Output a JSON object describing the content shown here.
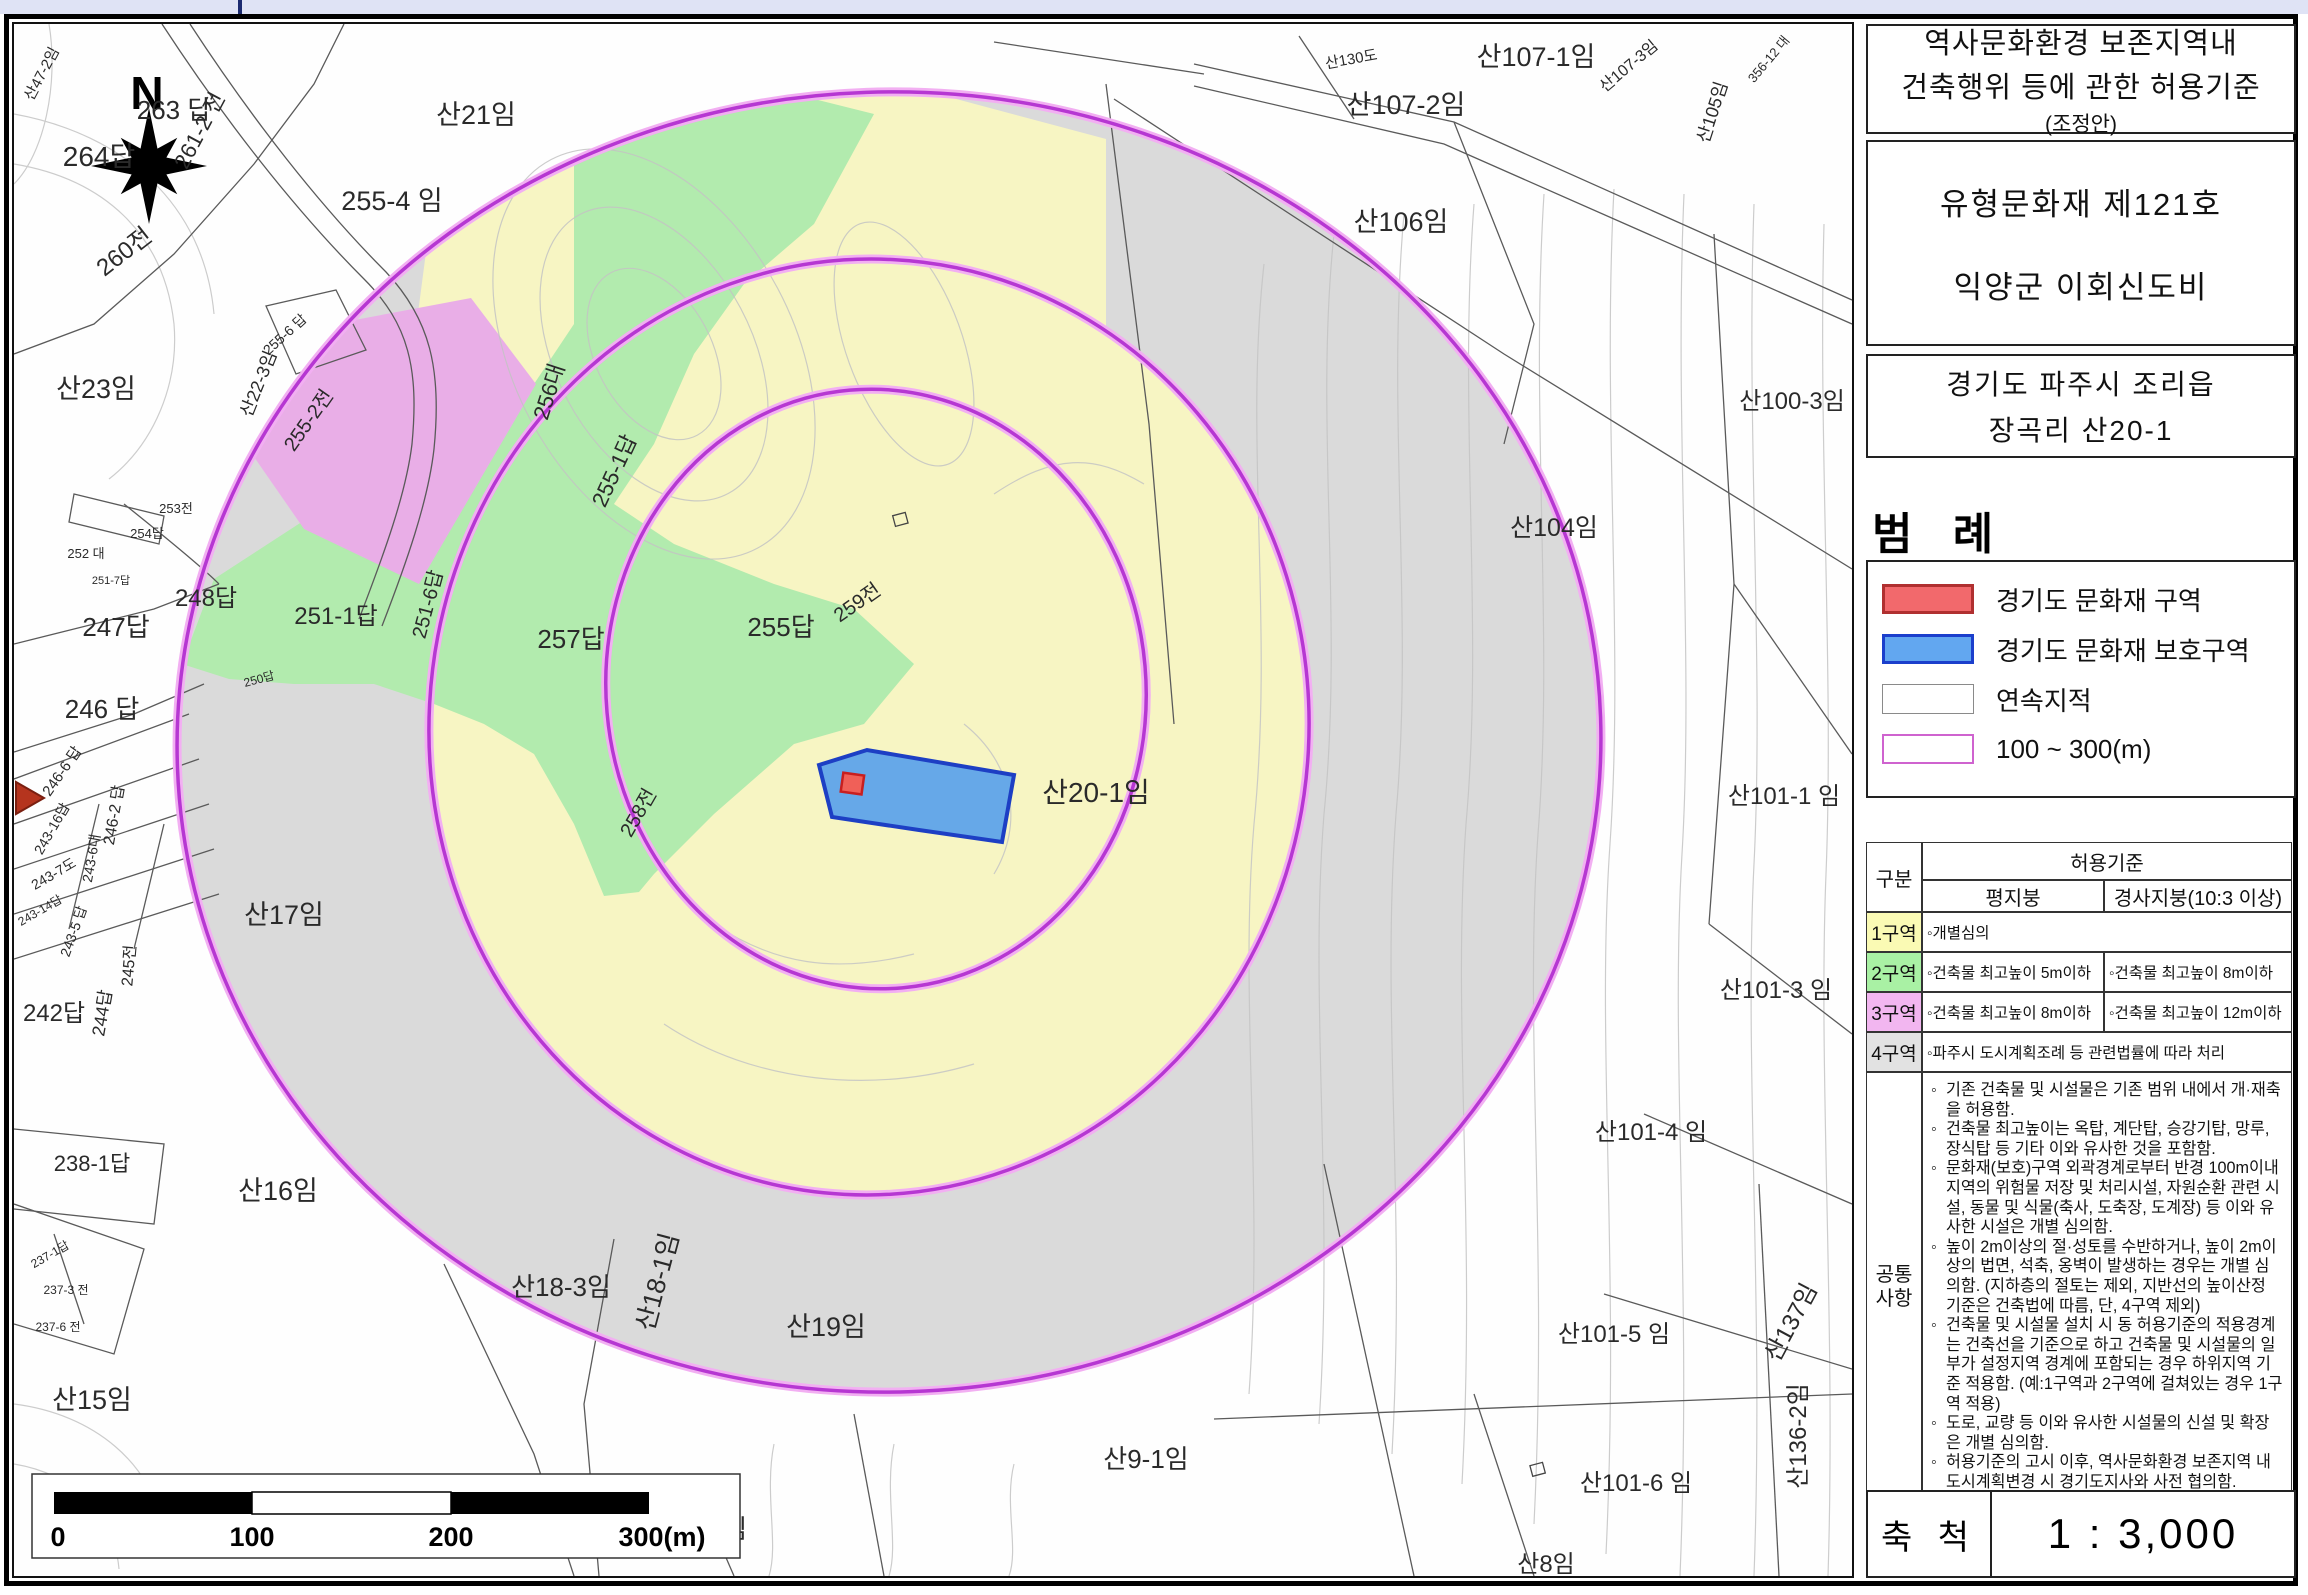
{
  "window": {
    "top_strip_color": "#dfe3f5",
    "frame_color": "#000000"
  },
  "side_panel": {
    "title_box": {
      "line1": "역사문화환경 보존지역내",
      "line2": "건축행위 등에 관한 허용기준",
      "line3": "(조정안)"
    },
    "heritage_box": {
      "line1": "유형문화재 제121호",
      "line2": "익양군 이회신도비"
    },
    "address_box": {
      "line1": "경기도 파주시 조리읍",
      "line2": "장곡리 산20-1"
    },
    "legend": {
      "title": "범 례",
      "items": [
        {
          "label": "경기도 문화재 구역",
          "fill": "#f2696c",
          "border": "#b03030"
        },
        {
          "label": "경기도 문화재 보호구역",
          "fill": "#62a7f0",
          "border": "#1b3fcc"
        },
        {
          "label": "연속지적",
          "fill": "#ffffff",
          "border": "#8a8a8a"
        },
        {
          "label": "100 ~ 300(m)",
          "fill": "#ffffff",
          "border": "#cf63cf"
        }
      ]
    },
    "table": {
      "col_header": "구분",
      "span_header": "허용기준",
      "sub_headers": [
        "평지붕",
        "경사지붕(10:3 이상)"
      ],
      "rows": [
        {
          "zone": "1구역",
          "color": "#fafab4",
          "flat": "◦개별심의",
          "slope": "",
          "span": true
        },
        {
          "zone": "2구역",
          "color": "#a9f1a4",
          "flat": "◦건축물 최고높이 5m이하",
          "slope": "◦건축물 최고높이 8m이하",
          "span": false
        },
        {
          "zone": "3구역",
          "color": "#f2b6f0",
          "flat": "◦건축물 최고높이 8m이하",
          "slope": "◦건축물 최고높이 12m이하",
          "span": false
        },
        {
          "zone": "4구역",
          "color": "#e2e2e2",
          "flat": "◦파주시 도시계획조례 등 관련법률에 따라 처리",
          "slope": "",
          "span": true
        }
      ],
      "common": {
        "zone_line1": "공통",
        "zone_line2": "사항",
        "bullets": [
          "기존 건축물 및 시설물은 기존 범위 내에서 개·재축을 허용함.",
          "건축물 최고높이는 옥탑, 계단탑, 승강기탑, 망루, 장식탑 등 기타 이와 유사한 것을 포함함.",
          "문화재(보호)구역 외곽경계로부터 반경 100m이내 지역의 위험물 저장 및 처리시설, 자원순환 관련 시설, 동물 및 식물(축사, 도축장, 도계장) 등 이와 유사한 시설은 개별 심의함.",
          "높이 2m이상의 절·성토를 수반하거나, 높이 2m이상의 법면, 석축, 옹벽이 발생하는 경우는 개별 심의함. (지하층의 절토는 제외, 지반선의 높이산정 기준은 건축법에 따름, 단, 4구역 제외)",
          "건축물 및 시설물 설치 시 동 허용기준의 적용경계는 건축선을 기준으로 하고 건축물 및 시설물의 일부가 설정지역 경계에 포함되는 경우 하위지역 기준 적용함. (예:1구역과 2구역에 걸쳐있는 경우 1구역 적용)",
          "도로, 교량 등 이와 유사한 시설물의 신설 및 확장은 개별 심의함.",
          "허용기준의 고시 이후, 역사문화환경 보존지역 내 도시계획변경 시 경기도지사와 사전 협의함."
        ]
      }
    },
    "scale_box": {
      "label": "축 척",
      "value": "1 : 3,000"
    }
  },
  "map": {
    "compass_label": "N",
    "colors": {
      "zone1_yellow": "#f7f5c3",
      "zone2_green": "#b2ebae",
      "zone3_pink": "#e9aee7",
      "zone4_gray": "#dadada",
      "ring_purple": "#b637d2",
      "protection_blue": "#66a8e8",
      "protection_border": "#1d3fc4",
      "heritage_red": "#f06058"
    },
    "scale_bar": {
      "ticks": [
        "0",
        "100",
        "200",
        "300(m)"
      ]
    },
    "labels": [
      {
        "t": "263 답",
        "x": 160,
        "y": 95,
        "s": 26
      },
      {
        "t": "264답",
        "x": 85,
        "y": 142,
        "s": 28
      },
      {
        "t": "산47-2임",
        "x": 32,
        "y": 52,
        "s": 15,
        "r": -62
      },
      {
        "t": "260전",
        "x": 115,
        "y": 234,
        "s": 24,
        "r": -38
      },
      {
        "t": "261-2 전",
        "x": 192,
        "y": 110,
        "s": 22,
        "r": -62
      },
      {
        "t": "255-4 임",
        "x": 378,
        "y": 186,
        "s": 27
      },
      {
        "t": "산21임",
        "x": 462,
        "y": 100,
        "s": 27
      },
      {
        "t": "255-6 답",
        "x": 274,
        "y": 314,
        "s": 14,
        "r": -42
      },
      {
        "t": "산23임",
        "x": 82,
        "y": 374,
        "s": 27
      },
      {
        "t": "253전",
        "x": 162,
        "y": 489,
        "s": 13
      },
      {
        "t": "254답",
        "x": 133,
        "y": 514,
        "s": 13
      },
      {
        "t": "252 대",
        "x": 72,
        "y": 534,
        "s": 13
      },
      {
        "t": "251-7답",
        "x": 97,
        "y": 560,
        "s": 11
      },
      {
        "t": "산22-3임",
        "x": 250,
        "y": 362,
        "s": 18,
        "r": -68
      },
      {
        "t": "255-2전",
        "x": 300,
        "y": 400,
        "s": 20,
        "r": -55
      },
      {
        "t": "256대",
        "x": 542,
        "y": 370,
        "s": 22,
        "r": -72
      },
      {
        "t": "255-1답",
        "x": 607,
        "y": 450,
        "s": 22,
        "r": -65
      },
      {
        "t": "248답",
        "x": 192,
        "y": 582,
        "s": 24
      },
      {
        "t": "250답",
        "x": 246,
        "y": 659,
        "s": 12,
        "r": -15
      },
      {
        "t": "251-1답",
        "x": 322,
        "y": 600,
        "s": 24
      },
      {
        "t": "251-6답",
        "x": 420,
        "y": 582,
        "s": 20,
        "r": -75
      },
      {
        "t": "257답",
        "x": 557,
        "y": 624,
        "s": 26
      },
      {
        "t": "255답",
        "x": 767,
        "y": 612,
        "s": 26
      },
      {
        "t": "259전",
        "x": 847,
        "y": 584,
        "s": 20,
        "r": -35
      },
      {
        "t": "258전",
        "x": 630,
        "y": 792,
        "s": 20,
        "r": -60
      },
      {
        "t": "247답",
        "x": 102,
        "y": 612,
        "s": 26
      },
      {
        "t": "246 답",
        "x": 88,
        "y": 694,
        "s": 26
      },
      {
        "t": "246-6 답",
        "x": 52,
        "y": 750,
        "s": 15,
        "r": -55
      },
      {
        "t": "246-2 답",
        "x": 105,
        "y": 792,
        "s": 16,
        "r": -80
      },
      {
        "t": "243-16답",
        "x": 42,
        "y": 807,
        "s": 14,
        "r": -60
      },
      {
        "t": "243-6대",
        "x": 82,
        "y": 835,
        "s": 14,
        "r": -80
      },
      {
        "t": "243-7도",
        "x": 42,
        "y": 854,
        "s": 14,
        "r": -30
      },
      {
        "t": "243-14답",
        "x": 28,
        "y": 890,
        "s": 12,
        "r": -30
      },
      {
        "t": "243-5 답",
        "x": 64,
        "y": 909,
        "s": 14,
        "r": -70
      },
      {
        "t": "245전",
        "x": 120,
        "y": 942,
        "s": 16,
        "r": -85
      },
      {
        "t": "242답",
        "x": 40,
        "y": 997,
        "s": 24
      },
      {
        "t": "244답",
        "x": 94,
        "y": 990,
        "s": 18,
        "r": -80
      },
      {
        "t": "238-1답",
        "x": 78,
        "y": 1147,
        "s": 22
      },
      {
        "t": "237-1답",
        "x": 38,
        "y": 1234,
        "s": 12,
        "r": -30
      },
      {
        "t": "237-3 전",
        "x": 52,
        "y": 1270,
        "s": 12
      },
      {
        "t": "237-6 전",
        "x": 44,
        "y": 1307,
        "s": 12
      },
      {
        "t": "산17임",
        "x": 270,
        "y": 900,
        "s": 27
      },
      {
        "t": "산16임",
        "x": 264,
        "y": 1176,
        "s": 27
      },
      {
        "t": "산15임",
        "x": 78,
        "y": 1385,
        "s": 27
      },
      {
        "t": "산18-3임",
        "x": 547,
        "y": 1272,
        "s": 26
      },
      {
        "t": "산18-1임",
        "x": 652,
        "y": 1260,
        "s": 26,
        "r": -75
      },
      {
        "t": "산19임",
        "x": 812,
        "y": 1312,
        "s": 27
      },
      {
        "t": "산9임",
        "x": 702,
        "y": 1514,
        "s": 26
      },
      {
        "t": "산9-1임",
        "x": 1132,
        "y": 1444,
        "s": 26
      },
      {
        "t": "산8임",
        "x": 1532,
        "y": 1548,
        "s": 24
      },
      {
        "t": "산101-6 임",
        "x": 1622,
        "y": 1467,
        "s": 24
      },
      {
        "t": "산136-2임",
        "x": 1792,
        "y": 1412,
        "s": 24,
        "r": -90
      },
      {
        "t": "산137임",
        "x": 1784,
        "y": 1302,
        "s": 24,
        "r": -62
      },
      {
        "t": "산101-5 임",
        "x": 1600,
        "y": 1318,
        "s": 24
      },
      {
        "t": "산101-4 임",
        "x": 1637,
        "y": 1116,
        "s": 24
      },
      {
        "t": "산101-3 임",
        "x": 1762,
        "y": 974,
        "s": 24
      },
      {
        "t": "산101-1 임",
        "x": 1770,
        "y": 780,
        "s": 24
      },
      {
        "t": "산104임",
        "x": 1540,
        "y": 512,
        "s": 25
      },
      {
        "t": "산100-3임",
        "x": 1778,
        "y": 385,
        "s": 24
      },
      {
        "t": "산106임",
        "x": 1387,
        "y": 207,
        "s": 27
      },
      {
        "t": "산107-2임",
        "x": 1392,
        "y": 90,
        "s": 27
      },
      {
        "t": "산107-1임",
        "x": 1522,
        "y": 42,
        "s": 27
      },
      {
        "t": "산130도",
        "x": 1338,
        "y": 40,
        "s": 15,
        "r": -10
      },
      {
        "t": "산107-3임",
        "x": 1618,
        "y": 46,
        "s": 16,
        "r": -40
      },
      {
        "t": "산105임",
        "x": 1704,
        "y": 90,
        "s": 18,
        "r": -72
      },
      {
        "t": "356-12 대",
        "x": 1758,
        "y": 38,
        "s": 13,
        "r": -50
      },
      {
        "t": "산20-1임",
        "x": 1082,
        "y": 778,
        "s": 28
      }
    ]
  }
}
